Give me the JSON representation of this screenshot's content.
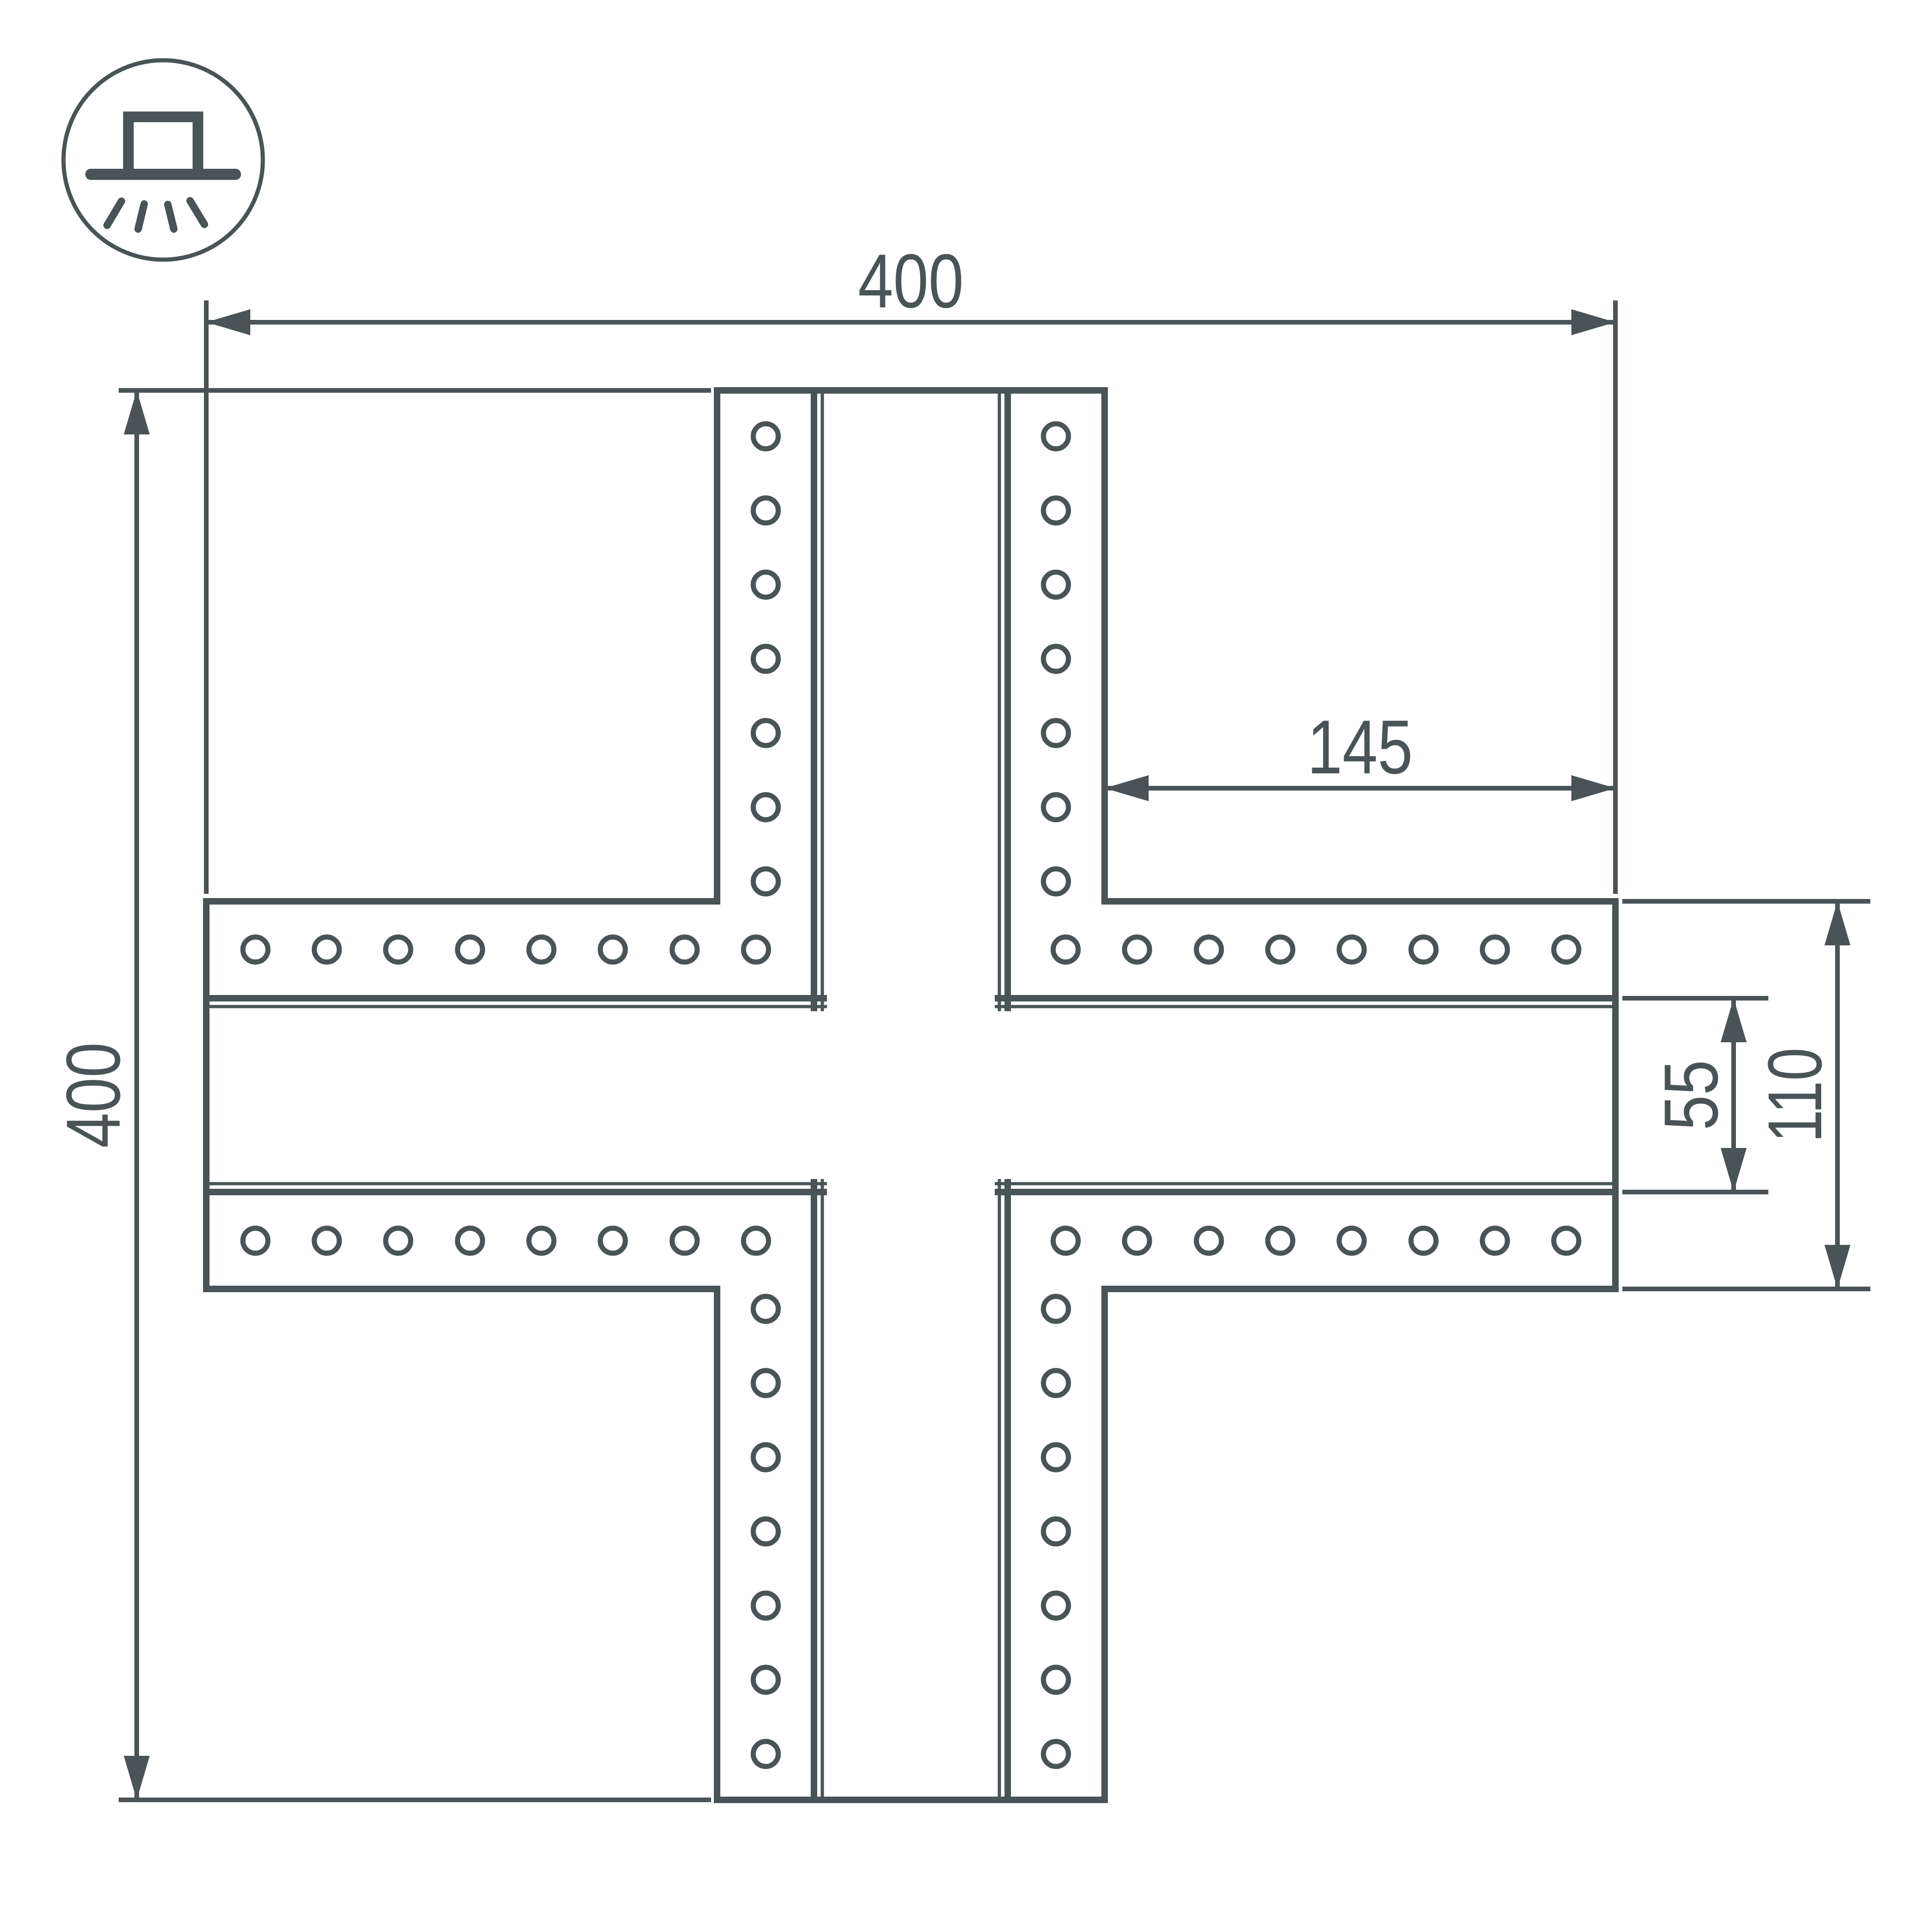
{
  "page": {
    "background": "#ffffff"
  },
  "colors": {
    "line": "#4a5355"
  },
  "icon": {
    "name": "surface-mounted-luminaire-icon"
  },
  "dimensions": {
    "total_width": "400",
    "total_height": "400",
    "arm_length": "145",
    "channel_width": "55",
    "arm_width": "110"
  }
}
